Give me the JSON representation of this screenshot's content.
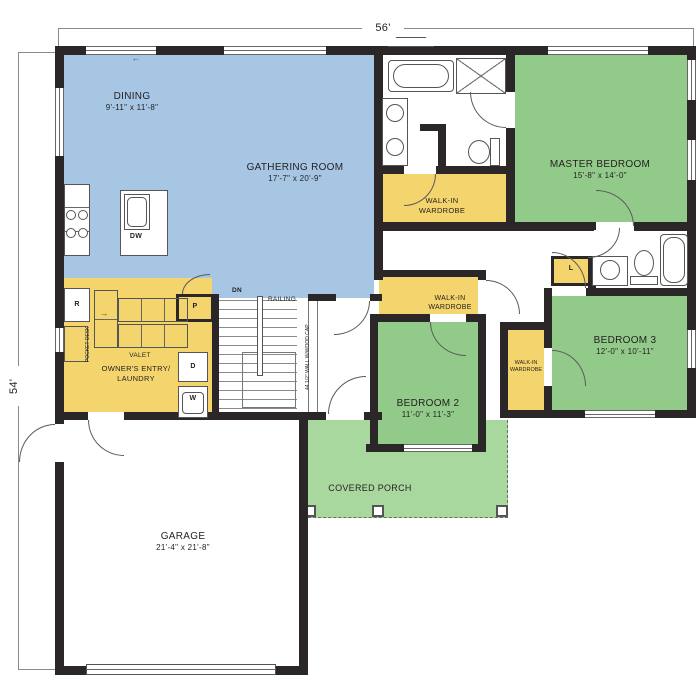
{
  "dim": {
    "top": "56'",
    "left": "54'"
  },
  "rooms": {
    "dining": {
      "name": "DINING",
      "size": "9'-11\" x 11'-8\""
    },
    "gathering": {
      "name": "GATHERING ROOM",
      "size": "17'-7\" x 20'-9\""
    },
    "master_bedroom": {
      "name": "MASTER BEDROOM",
      "size": "15'-8\" x 14'-0\""
    },
    "bedroom2": {
      "name": "BEDROOM 2",
      "size": "11'-0\" x 11'-3\""
    },
    "bedroom3": {
      "name": "BEDROOM 3",
      "size": "12'-0\" x 10'-11\""
    },
    "garage": {
      "name": "GARAGE",
      "size": "21'-4\" x 21'-8\""
    },
    "covered_porch": {
      "name": "COVERED PORCH"
    },
    "owners_entry": {
      "line1": "OWNER'S ENTRY/",
      "line2": "LAUNDRY"
    },
    "walk_in_wardrobe": {
      "line1": "WALK-IN",
      "line2": "WARDROBE"
    }
  },
  "labels": {
    "dn": "DN",
    "railing": "RAILING",
    "pony_wall": "44 1/2\" WALL W/WOOD CAP",
    "pocket_desk": "POCKET DESK",
    "valet": "VALET",
    "dishwasher": "DW",
    "refrigerator": "R",
    "pantry": "P",
    "dryer": "D",
    "washer": "W",
    "linen": "L"
  },
  "colors": {
    "living": "#a6c6e3",
    "bedroom": "#92ca89",
    "porch": "#a9d89f",
    "casework": "#f4d56d",
    "wall": "#2b2627"
  }
}
